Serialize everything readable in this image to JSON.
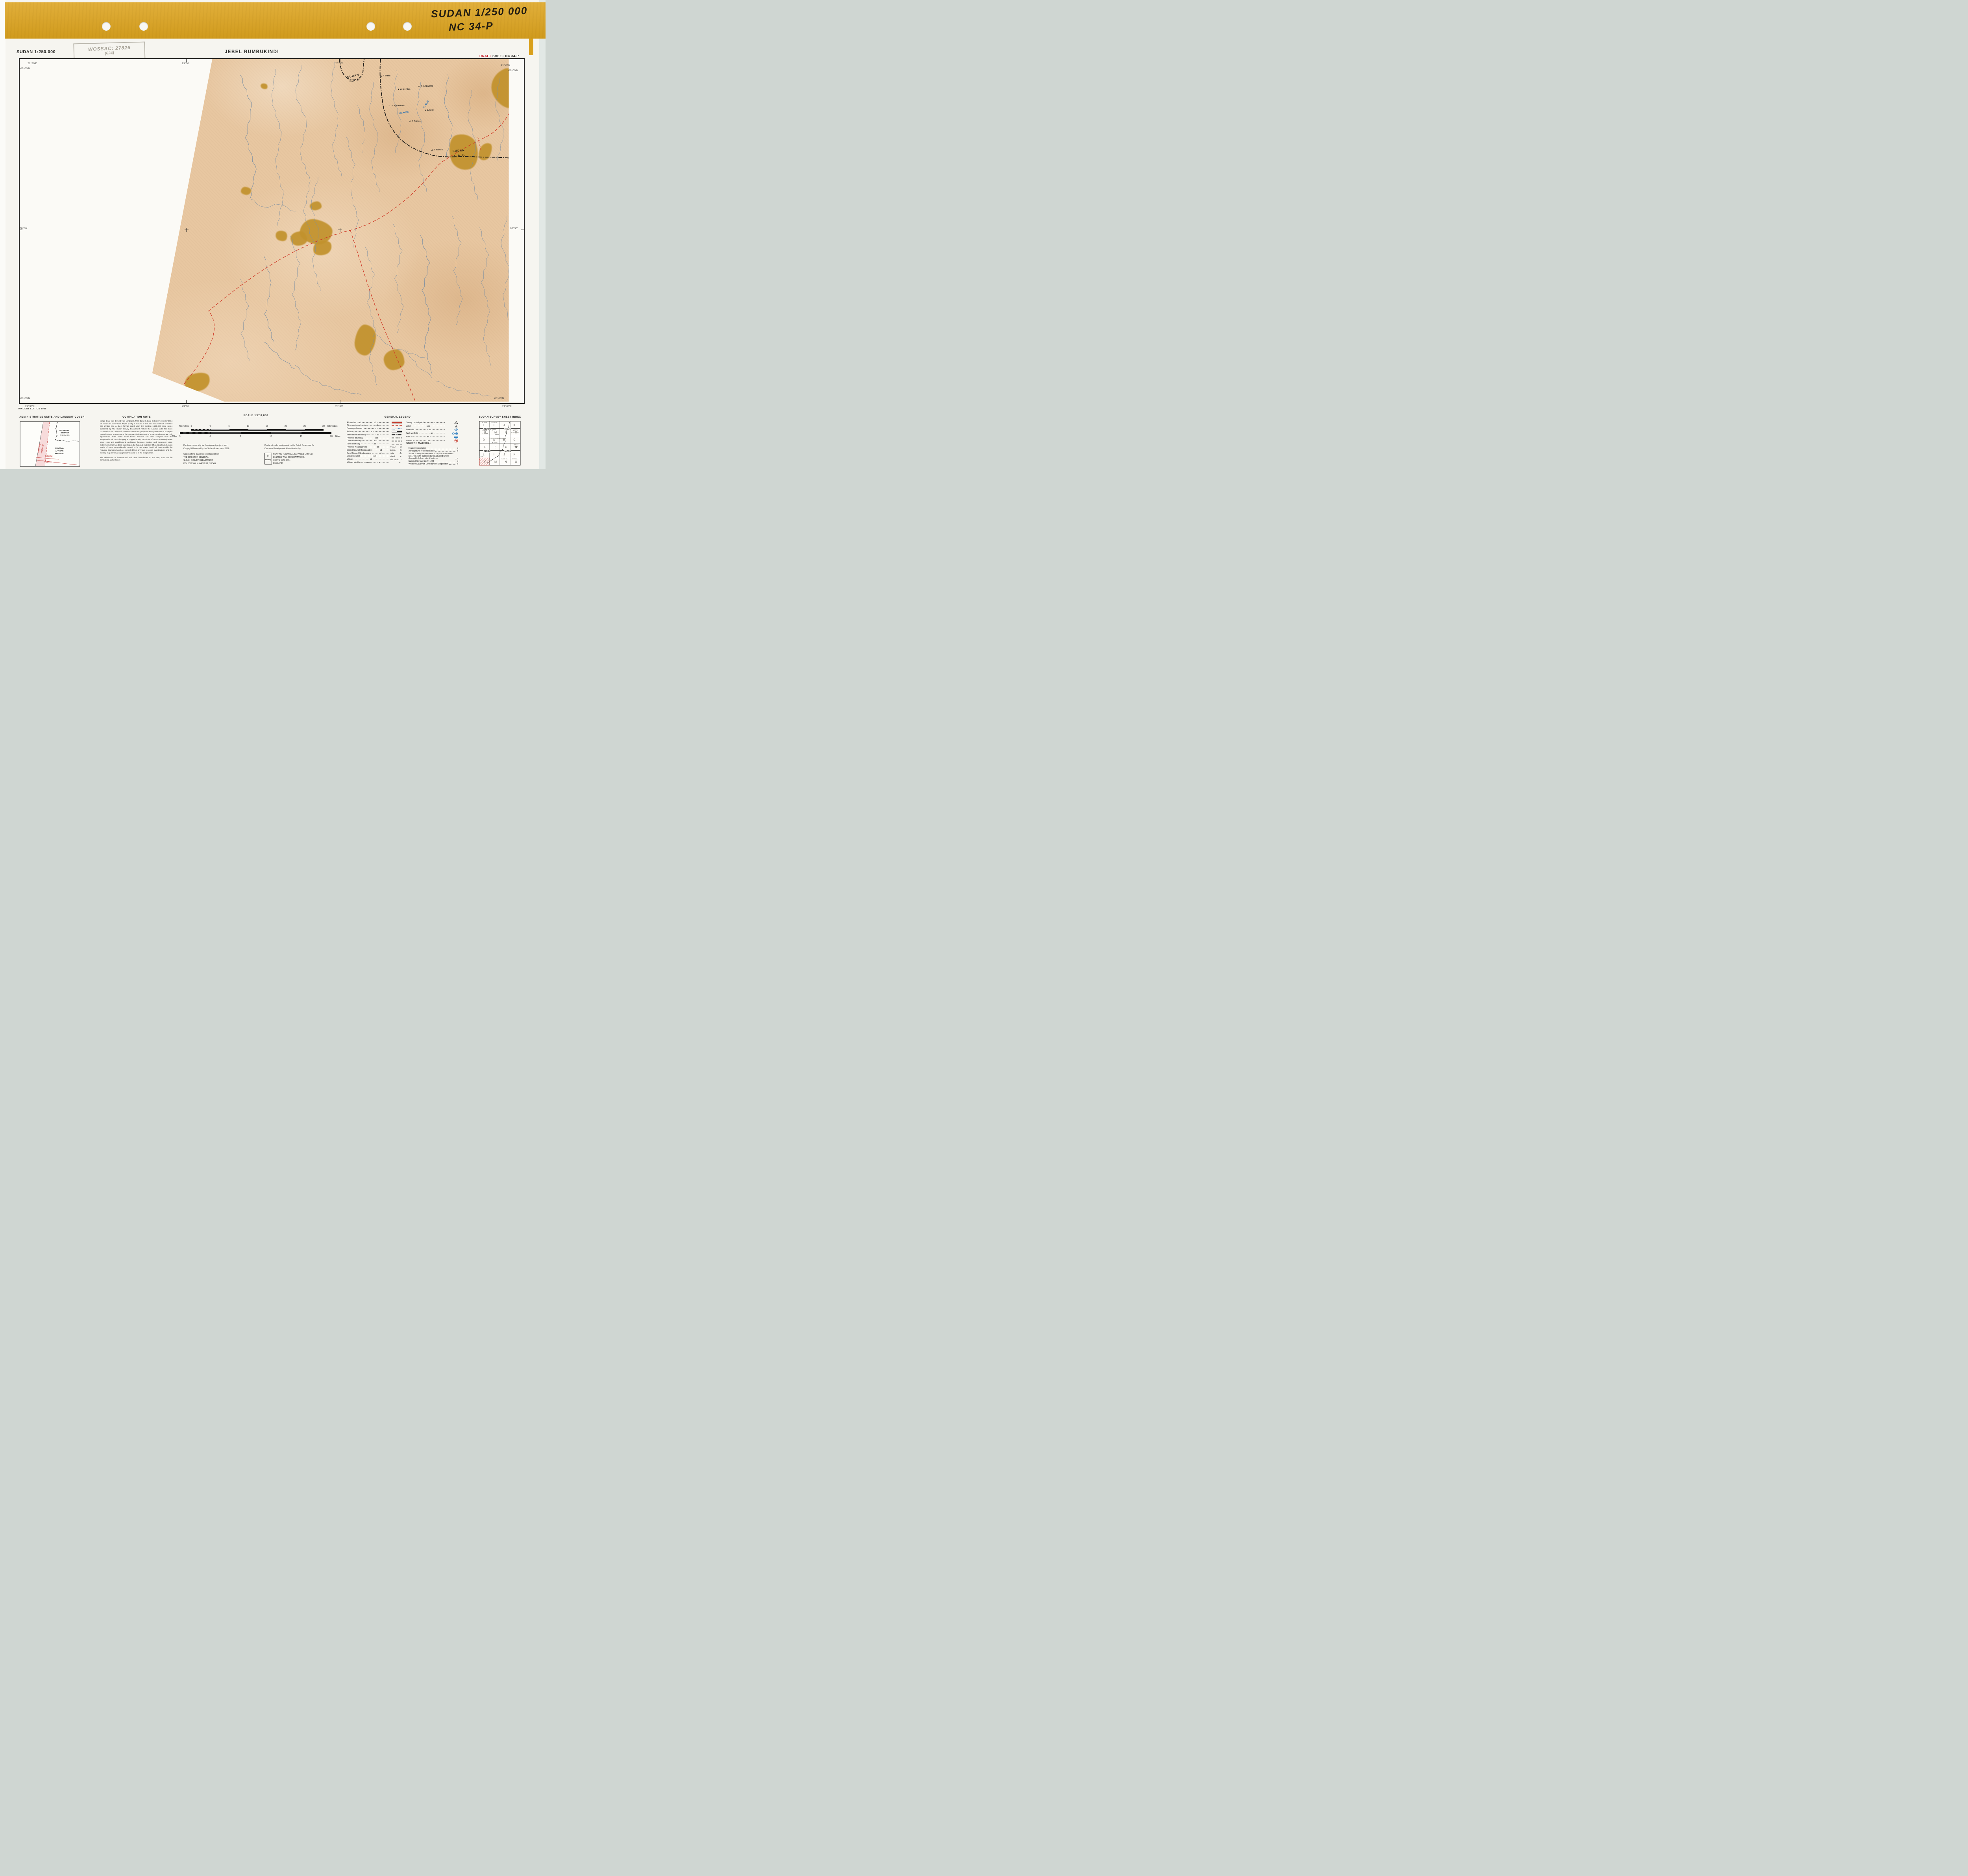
{
  "binder": {
    "note_line1": "SUDAN 1/250 000",
    "note_line2": "NC 34-P"
  },
  "header": {
    "series": "SUDAN 1:250,000",
    "stamp_line1": "WOSSAC: 27826",
    "stamp_line2": "(624)",
    "title": "JEBEL RUMBUKINDI",
    "draft_word": "DRAFT",
    "sheet_word": "SHEET NC 34-P"
  },
  "map": {
    "edition": "IMAGERY EDITION 1986",
    "graticule": [
      {
        "t": "22°30'E",
        "x": 70,
        "y": 158
      },
      {
        "t": "09°00'N",
        "x": 52,
        "y": 171
      },
      {
        "t": "23°00'",
        "x": 462,
        "y": 158
      },
      {
        "t": "23°30'",
        "x": 852,
        "y": 158
      },
      {
        "t": "24°00'E",
        "x": 1272,
        "y": 162
      },
      {
        "t": "09°00'N",
        "x": 1292,
        "y": 176
      },
      {
        "t": "08°30'",
        "x": 50,
        "y": 577
      },
      {
        "t": "08°30'",
        "x": 1296,
        "y": 577
      },
      {
        "t": "08°00'N",
        "x": 52,
        "y": 1009
      },
      {
        "t": "22°30'E",
        "x": 64,
        "y": 1029
      },
      {
        "t": "23°00'",
        "x": 462,
        "y": 1029
      },
      {
        "t": "23°30'",
        "x": 852,
        "y": 1029
      },
      {
        "t": "08°00'N",
        "x": 1256,
        "y": 1009
      },
      {
        "t": "24°00'E",
        "x": 1276,
        "y": 1029
      }
    ],
    "boundary_labels": [
      {
        "t": "SUDAN",
        "x": 832,
        "y": 40,
        "r": -12
      },
      {
        "t": "C.A.R.",
        "x": 838,
        "y": 51,
        "r": -12
      },
      {
        "t": "SUDAN",
        "x": 1100,
        "y": 230,
        "r": -4
      },
      {
        "t": "C.A.R.",
        "x": 1104,
        "y": 242,
        "r": -4
      }
    ],
    "features": [
      {
        "t": "J. Busu",
        "x": 916,
        "y": 40,
        "sym": "open"
      },
      {
        "t": "J. Merijen",
        "x": 960,
        "y": 74,
        "sym": "filled"
      },
      {
        "t": "J. Angwawa",
        "x": 1012,
        "y": 66,
        "sym": "filled"
      },
      {
        "t": "J. Ajarbacha",
        "x": 938,
        "y": 116,
        "sym": "filled"
      },
      {
        "t": "J. Nibi",
        "x": 1028,
        "y": 127,
        "sym": "filled"
      },
      {
        "t": "J. Kalala",
        "x": 990,
        "y": 155,
        "sym": "open"
      },
      {
        "t": "J. Hamid",
        "x": 1046,
        "y": 228,
        "sym": "open"
      }
    ],
    "waters": [
      {
        "t": "W. Adda",
        "x": 964,
        "y": 133,
        "r": -10
      },
      {
        "t": "K. Said",
        "x": 1022,
        "y": 112,
        "r": -55
      }
    ]
  },
  "admin_panel": {
    "title": "ADMINISTRATIVE UNITS AND LANDSAT COVER",
    "district1": "SOUTHERN",
    "district2": "DISTRICT",
    "district3": "RADOM R.C.",
    "car1": "CENTRAL",
    "car2": "AFRICAN",
    "car3": "REPUBLIC",
    "path1": "PATH 179",
    "path2": "PATH 178",
    "row1": "ROW 54",
    "row2": "ROW 55"
  },
  "compilation": {
    "title": "COMPILATION NOTE",
    "paragraphs": [
      "Image detail was derived from Landsat 5, MSS Band 7 dated October/November 1984 on Computer Compatible Tapes (CCT). A mosaic of this data was contrast stretched and divided into a sheet format based upon the existing 1:250,000 scale series published by The Sudan Survey Department. Whilst the Landsat data has been corrected to the Universal Transverse Mercator projection the sparseness of surveyed ground control points means the geographical accuracy of sheet coordinates are only approximate. Data within South Darfur Province has been compiled from the interpretation of colour imagery at mapped scale, correlation of resource investigations since 1966 and aerial/ground verification between October and December 1985. Settlement detail has been based upon the National Statistics Office, Khartoum Census Study of 1983 geographically located to fit the image detail. All data outside the Province boundary has been compiled from previous resource investigations and the existing map series geographically located to fit the image detail.",
      "The delineation of international and other boundaries on this map must not be considered authoritative."
    ]
  },
  "scale": {
    "title": "SCALE 1:250,000",
    "km_word": "Kilometres",
    "miles_word": "Miles",
    "km_ticks": [
      "5",
      "0",
      "5",
      "10",
      "15",
      "20",
      "25",
      "30"
    ],
    "mile_ticks": [
      "5",
      "0",
      "5",
      "10",
      "15",
      "20"
    ]
  },
  "publisher": {
    "left_a": [
      "Published especially for development projects and",
      "Copyright Reserved by the Sudan Government 1986"
    ],
    "left_b": [
      "Copies of this map may be obtained from",
      "THE DIRECTOR GENERAL,",
      "SUDAN SURVEY DEPARTMENT,",
      "P.O. BOX 306, KHARTOUM, SUDAN."
    ],
    "right_a": [
      "Produced under assignment for the British Government's",
      "Overseas Development Administration by"
    ],
    "company": [
      "HUNTING TECHNICAL SERVICES LIMITED,",
      "ELSTREE WAY, BOREHAMWOOD,",
      "HERTS, WD6 1SB.,",
      "ENGLAND."
    ],
    "logo_text": "Hunting"
  },
  "legend": {
    "title": "GENERAL LEGEND",
    "left_rows": [
      {
        "label": "All weather road",
        "code": "ab",
        "sym": "road_red"
      },
      {
        "label": "Other routes or tracks",
        "code": "ab",
        "sym": "track_red_dash"
      },
      {
        "label": "Drainage channel",
        "code": "a",
        "sym": "drainage_blue"
      },
      {
        "label": "Railway",
        "code": "a",
        "sym": "railway"
      },
      {
        "label": "International boundary",
        "code": "ac",
        "sym": "intl_boundary"
      },
      {
        "label": "Province boundary",
        "code": "acd",
        "sym": "province_boundary"
      },
      {
        "label": "District boundary",
        "code": "acd",
        "sym": "district_boundary"
      },
      {
        "label": "Rural boundary",
        "code": "ad",
        "sym": "rural_boundary"
      },
      {
        "label": "Province Headquarters",
        "code": "ad",
        "sym": "hq_province",
        "sym_label": "NYALA"
      },
      {
        "label": "District Council Headquarters",
        "code": "ad",
        "sym": "hq_district",
        "sym_label": "Buram"
      },
      {
        "label": "Rural Council Headquarters",
        "code": "ad",
        "sym": "hq_rural",
        "sym_label": "Adila"
      },
      {
        "label": "Village Council",
        "code": "ad",
        "sym": "village_council",
        "sym_label": "Sherif"
      },
      {
        "label": "Village",
        "code": "ad",
        "sym": "village",
        "sym_label": "Abu Hamid"
      },
      {
        "label": "Village, identity not known",
        "code": "a",
        "sym": "village_unknown"
      }
    ],
    "right_rows": [
      {
        "label": "Survey control point",
        "code": "c",
        "sym": "survey_point"
      },
      {
        "label": "Jebel",
        "code": "abc",
        "sym": "jebel"
      },
      {
        "label": "Borehole",
        "code": "ae",
        "sym": "borehole"
      },
      {
        "label": "Well; wellfield",
        "code": "ae",
        "sym": "well"
      },
      {
        "label": "Hafir",
        "code": "ae",
        "sym": "hafir"
      },
      {
        "label": "Airfield",
        "code": "ab",
        "sym": "airfield"
      }
    ],
    "source_title": "SOURCE MATERIAL",
    "source_rows": [
      {
        "label": "Image interpretation",
        "code": "a"
      },
      {
        "label": "Aerial/ground reconnaissance",
        "code": "b"
      },
      {
        "label": "Sudan Survey Department's 1:250,000 scale series (1917 to 1929) but boundaries adjusted where deemed to follow natural features",
        "code": "c"
      },
      {
        "label": "National Census Study, 1983",
        "code": "d"
      },
      {
        "label": "Western Savannah Development Corporation",
        "code": "e"
      }
    ]
  },
  "index": {
    "title": "SUDAN SURVEY SHEET INDEX",
    "letters": [
      [
        "L",
        "I",
        "J",
        "K"
      ],
      [
        "P",
        "M",
        "N",
        "O"
      ],
      [
        "D",
        "A",
        "B",
        "C"
      ],
      [
        "H",
        "E",
        "F",
        "G"
      ],
      [
        "L",
        "I",
        "J",
        "K"
      ],
      [
        "P",
        "M",
        "N",
        "O"
      ]
    ],
    "block_labels": [
      {
        "t": "ND34",
        "x": 14,
        "y": 21.5
      },
      {
        "t": "ND35",
        "x": 66,
        "y": 21.5
      },
      {
        "t": "NC34",
        "x": 14,
        "y": 78.5
      },
      {
        "t": "NC35",
        "x": 66,
        "y": 78.5
      }
    ],
    "region_labels": [
      {
        "t": "NORTH",
        "x": 15,
        "y": 7
      },
      {
        "t": "DARFUR",
        "x": 40,
        "y": 7
      },
      {
        "t": "NORTH",
        "x": 93,
        "y": 26
      },
      {
        "t": "KORDOFAN",
        "x": 93,
        "y": 31.5
      },
      {
        "t": "SOUTH",
        "x": 95,
        "y": 62
      },
      {
        "t": "K'FAN",
        "x": 94,
        "y": 67
      },
      {
        "t": "C.A.R.",
        "x": 7,
        "y": 92.5
      },
      {
        "t": "BAHR  EL",
        "x": 66,
        "y": 99
      },
      {
        "t": "GHAZAL",
        "x": 92,
        "y": 99
      }
    ],
    "towns": [
      {
        "t": "Zalingei",
        "x": 9,
        "y": 26
      },
      {
        "t": "Nyertete",
        "x": 31,
        "y": 25
      },
      {
        "t": "Garsila",
        "x": 11,
        "y": 34
      },
      {
        "t": "Nyala",
        "x": 42,
        "y": 37
      },
      {
        "t": "Idd el Ghanam",
        "x": 29,
        "y": 47.5
      },
      {
        "t": "Ed Da'ein",
        "x": 53,
        "y": 46.5
      },
      {
        "t": "Buram",
        "x": 36,
        "y": 57.5
      }
    ]
  }
}
